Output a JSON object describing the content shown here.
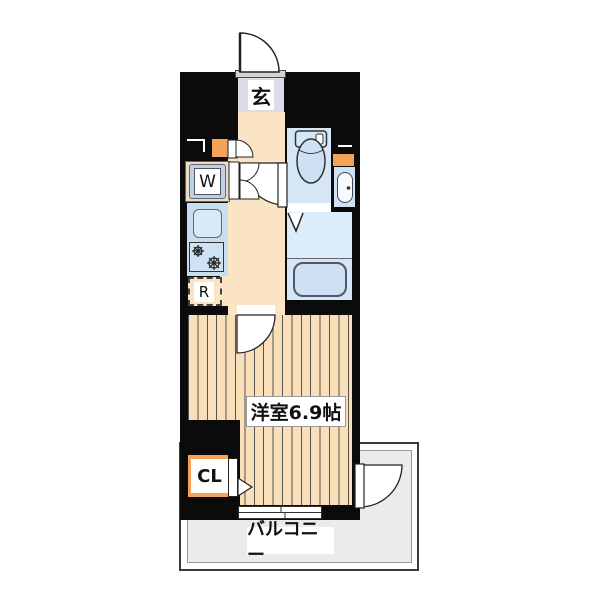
{
  "floorplan": {
    "title": "1K apartment floor plan",
    "labels": {
      "entrance": "玄",
      "washer": "W",
      "fridge": "R",
      "closet": "CL",
      "main_room": "洋室6.9帖",
      "balcony": "バルコニー"
    },
    "rooms": [
      {
        "name": "entrance",
        "label": "玄"
      },
      {
        "name": "hallway-kitchen",
        "label": ""
      },
      {
        "name": "toilet-room",
        "label": ""
      },
      {
        "name": "bathroom",
        "label": ""
      },
      {
        "name": "western-room",
        "label": "洋室6.9帖",
        "size_tatami": 6.9
      },
      {
        "name": "balcony",
        "label": "バルコニー"
      }
    ],
    "colors": {
      "wall": "#0b0b0b",
      "wood_floor": "#f9dfba",
      "hallway_floor": "#fbe4c3",
      "entrance_tile": "#dcdce8",
      "wet_area_blue": "#d5e6f7",
      "kitchen_blue": "#c9ddf1",
      "accent_orange": "#f5a259",
      "balcony_gray": "#ebebeb"
    }
  }
}
